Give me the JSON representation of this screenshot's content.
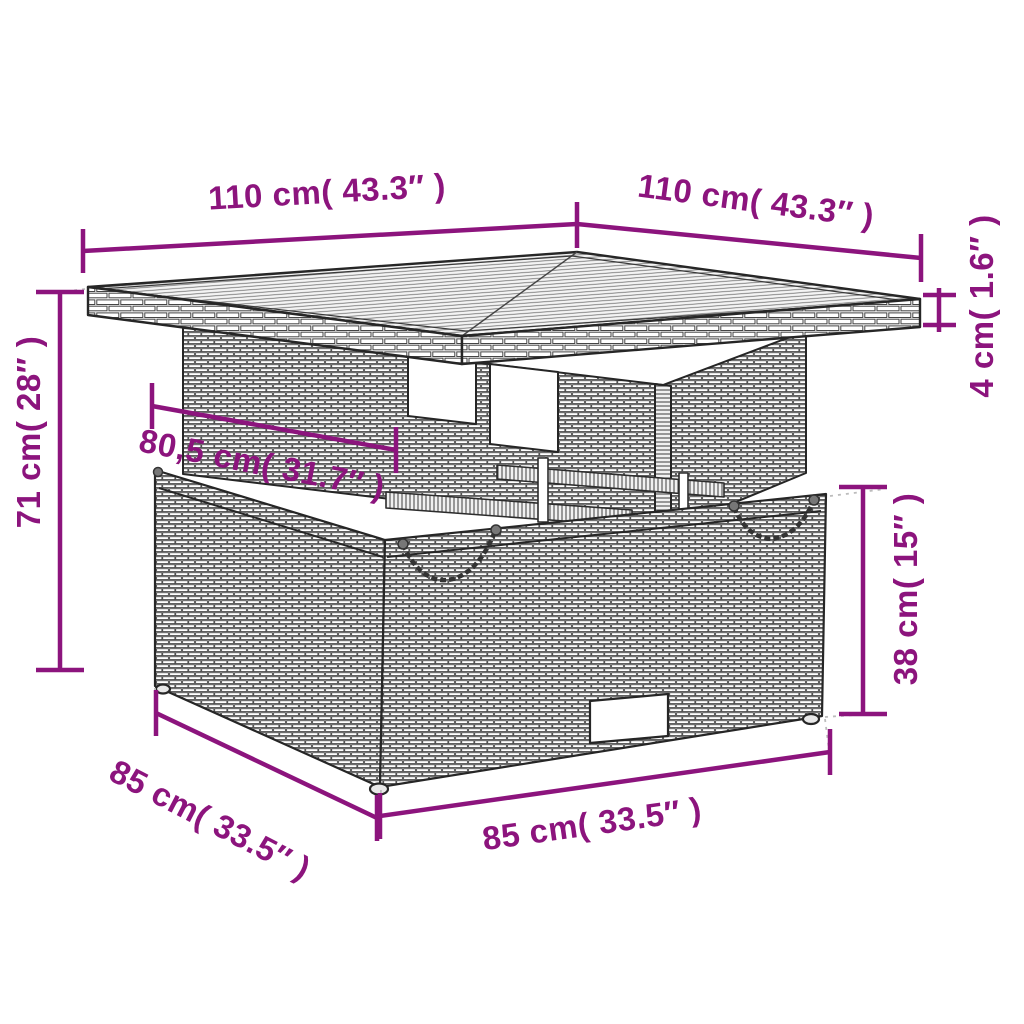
{
  "figure": {
    "type": "product-dimension-diagram",
    "subject": "poly-rattan garden table with storage box",
    "background_color": "#ffffff",
    "accent_color": "#8c147d",
    "drawing_line_color": "#2e2e2e"
  },
  "dimensions": {
    "tabletop_width": {
      "label": "110 cm( 43.3″ )",
      "cm": "110",
      "inches": "43.3"
    },
    "tabletop_depth": {
      "label": "110 cm( 43.3″ )",
      "cm": "110",
      "inches": "43.3"
    },
    "tabletop_thickness": {
      "label": "4 cm( 1.6″ )",
      "cm": "4",
      "inches": "1.6"
    },
    "table_height": {
      "label": "71 cm( 28″ )",
      "cm": "71",
      "inches": "28"
    },
    "apron_width": {
      "label": "80,5 cm( 31.7″ )",
      "cm": "80,5",
      "inches": "31.7"
    },
    "box_height": {
      "label": "38 cm( 15″ )",
      "cm": "38",
      "inches": "15"
    },
    "box_depth": {
      "label": "85 cm( 33.5″ )",
      "cm": "85",
      "inches": "33.5"
    },
    "box_width": {
      "label": "85 cm( 33.5″ )",
      "cm": "85",
      "inches": "33.5"
    }
  }
}
